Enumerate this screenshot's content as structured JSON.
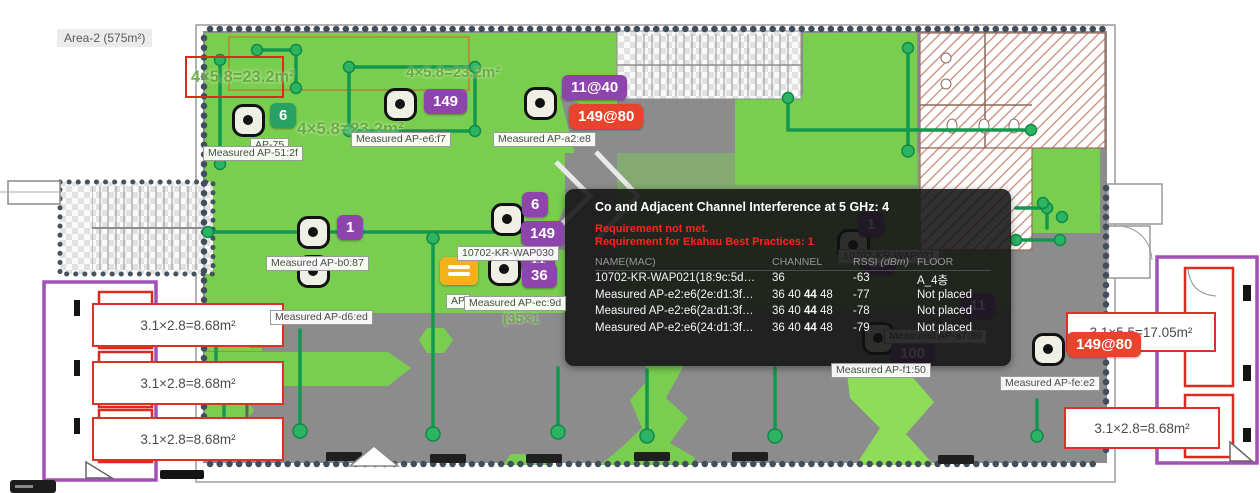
{
  "area_label": "Area-2 (575m²)",
  "colors": {
    "purple": "#8e44ad",
    "red": "#e8432d",
    "green": "#28a263",
    "coverage_green": "#79ce4f",
    "track_green": "#12984f",
    "floor_gray": "#8c8c8c",
    "tooltip_warning_red": "#ff2419"
  },
  "tooltip": {
    "title": "Co and Adjacent Channel Interference at 5 GHz: 4",
    "warning_line1": "Requirement not met.",
    "warning_line2": "Requirement for Ekahau Best Practices: 1",
    "columns": [
      {
        "label": "NAME(MAC)"
      },
      {
        "label": "CHANNEL"
      },
      {
        "label": "RSSI",
        "suffix": "(dBm)"
      },
      {
        "label": "FLOOR"
      }
    ],
    "rows": [
      {
        "name": "10702-KR-WAP021(18:9c:5d…",
        "channel_pre": "36",
        "channel_bold": "",
        "channel_post": "",
        "rssi": "-63",
        "floor": "A_4층"
      },
      {
        "name": "Measured AP-e2:e6(2e:d1:3f…",
        "channel_pre": "36 40 ",
        "channel_bold": "44",
        "channel_post": " 48",
        "rssi": "-77",
        "floor": "Not placed"
      },
      {
        "name": "Measured AP-e2:e6(2a:d1:3f…",
        "channel_pre": "36 40 ",
        "channel_bold": "44",
        "channel_post": " 48",
        "rssi": "-78",
        "floor": "Not placed"
      },
      {
        "name": "Measured AP-e2:e6(24:d1:3f…",
        "channel_pre": "36 40 ",
        "channel_bold": "44",
        "channel_post": " 48",
        "rssi": "-79",
        "floor": "Not placed"
      }
    ]
  },
  "map": {
    "note_label": "AP",
    "ap_markers": [
      {
        "x": 248,
        "y": 120
      },
      {
        "x": 400,
        "y": 104
      },
      {
        "x": 540,
        "y": 103
      },
      {
        "x": 313,
        "y": 232
      },
      {
        "x": 313,
        "y": 271
      },
      {
        "x": 507,
        "y": 219
      },
      {
        "x": 504,
        "y": 269
      },
      {
        "x": 1048,
        "y": 349
      },
      {
        "x": 853,
        "y": 245,
        "under": true
      },
      {
        "x": 878,
        "y": 338,
        "under": true
      }
    ],
    "badges": [
      {
        "text": "6",
        "x": 270,
        "y": 103,
        "color": "green"
      },
      {
        "text": "149",
        "x": 424,
        "y": 89,
        "color": "purple"
      },
      {
        "text": "11@40",
        "x": 562,
        "y": 75,
        "color": "purple"
      },
      {
        "text": "149@80",
        "x": 569,
        "y": 104,
        "color": "red"
      },
      {
        "text": "1",
        "x": 337,
        "y": 215,
        "color": "purple"
      },
      {
        "text": "6",
        "x": 522,
        "y": 192,
        "color": "purple"
      },
      {
        "text": "149",
        "x": 521,
        "y": 221,
        "color": "purple"
      },
      {
        "text": "11",
        "x": 521,
        "y": 247,
        "color": "purple"
      },
      {
        "text": "36",
        "x": 522,
        "y": 263,
        "color": "purple"
      },
      {
        "text": "149@80",
        "x": 1067,
        "y": 332,
        "color": "red"
      },
      {
        "text": "1",
        "x": 858,
        "y": 212,
        "color": "purple",
        "under": true
      },
      {
        "text": "36",
        "x": 860,
        "y": 250,
        "color": "purple",
        "under": true
      },
      {
        "text": "100",
        "x": 891,
        "y": 341,
        "color": "purple",
        "under": true
      },
      {
        "text": "11",
        "x": 961,
        "y": 293,
        "color": "purple",
        "under": true
      }
    ],
    "ap_labels": [
      {
        "text": "AP-75",
        "x": 250,
        "y": 138
      },
      {
        "text": "Measured AP-51:2f",
        "x": 203,
        "y": 146
      },
      {
        "text": "Measured AP-e6:f7",
        "x": 351,
        "y": 132
      },
      {
        "text": "Measured AP-a2:e8",
        "x": 493,
        "y": 132
      },
      {
        "text": "Measured AP-b0:87",
        "x": 266,
        "y": 256
      },
      {
        "text": "Measured AP-d6:ed",
        "x": 270,
        "y": 310
      },
      {
        "text": "10702-KR-WAP030",
        "x": 457,
        "y": 246
      },
      {
        "text": "AP",
        "x": 446,
        "y": 294
      },
      {
        "text": "Measured AP-ec:9d",
        "x": 464,
        "y": 296
      },
      {
        "text": "Measured AP-f1:50",
        "x": 831,
        "y": 363
      },
      {
        "text": "Measured AP-fe:e2",
        "x": 1000,
        "y": 376
      },
      {
        "text": "10702-KR-WAP021",
        "x": 838,
        "y": 249,
        "under": true
      },
      {
        "text": "Measured AP-a7:89",
        "x": 884,
        "y": 329,
        "under": true
      }
    ],
    "dim_texts": [
      {
        "text": "4×5.8=23.2m²",
        "x": 191,
        "y": 68,
        "fs": 16.5
      },
      {
        "text": "4×5.8=23.2m²",
        "x": 406,
        "y": 64,
        "fs": 15
      },
      {
        "text": "4×5.8=23.2m²",
        "x": 297,
        "y": 119,
        "fs": 17
      },
      {
        "text": "(35×1",
        "x": 503,
        "y": 310,
        "fs": 14
      }
    ],
    "dim_boxes": [
      {
        "text": "3.1×2.8=8.68m²",
        "x": 92,
        "y": 303,
        "w": 192,
        "h": 44
      },
      {
        "text": "3.1×2.8=8.68m²",
        "x": 92,
        "y": 361,
        "w": 192,
        "h": 44
      },
      {
        "text": "3.1×2.8=8.68m²",
        "x": 92,
        "y": 417,
        "w": 192,
        "h": 44
      },
      {
        "text": "3.1×5.5=17.05m²",
        "x": 1066,
        "y": 312,
        "w": 150,
        "h": 40
      },
      {
        "text": "3.1×2.8=8.68m²",
        "x": 1064,
        "y": 407,
        "w": 156,
        "h": 42
      }
    ]
  }
}
